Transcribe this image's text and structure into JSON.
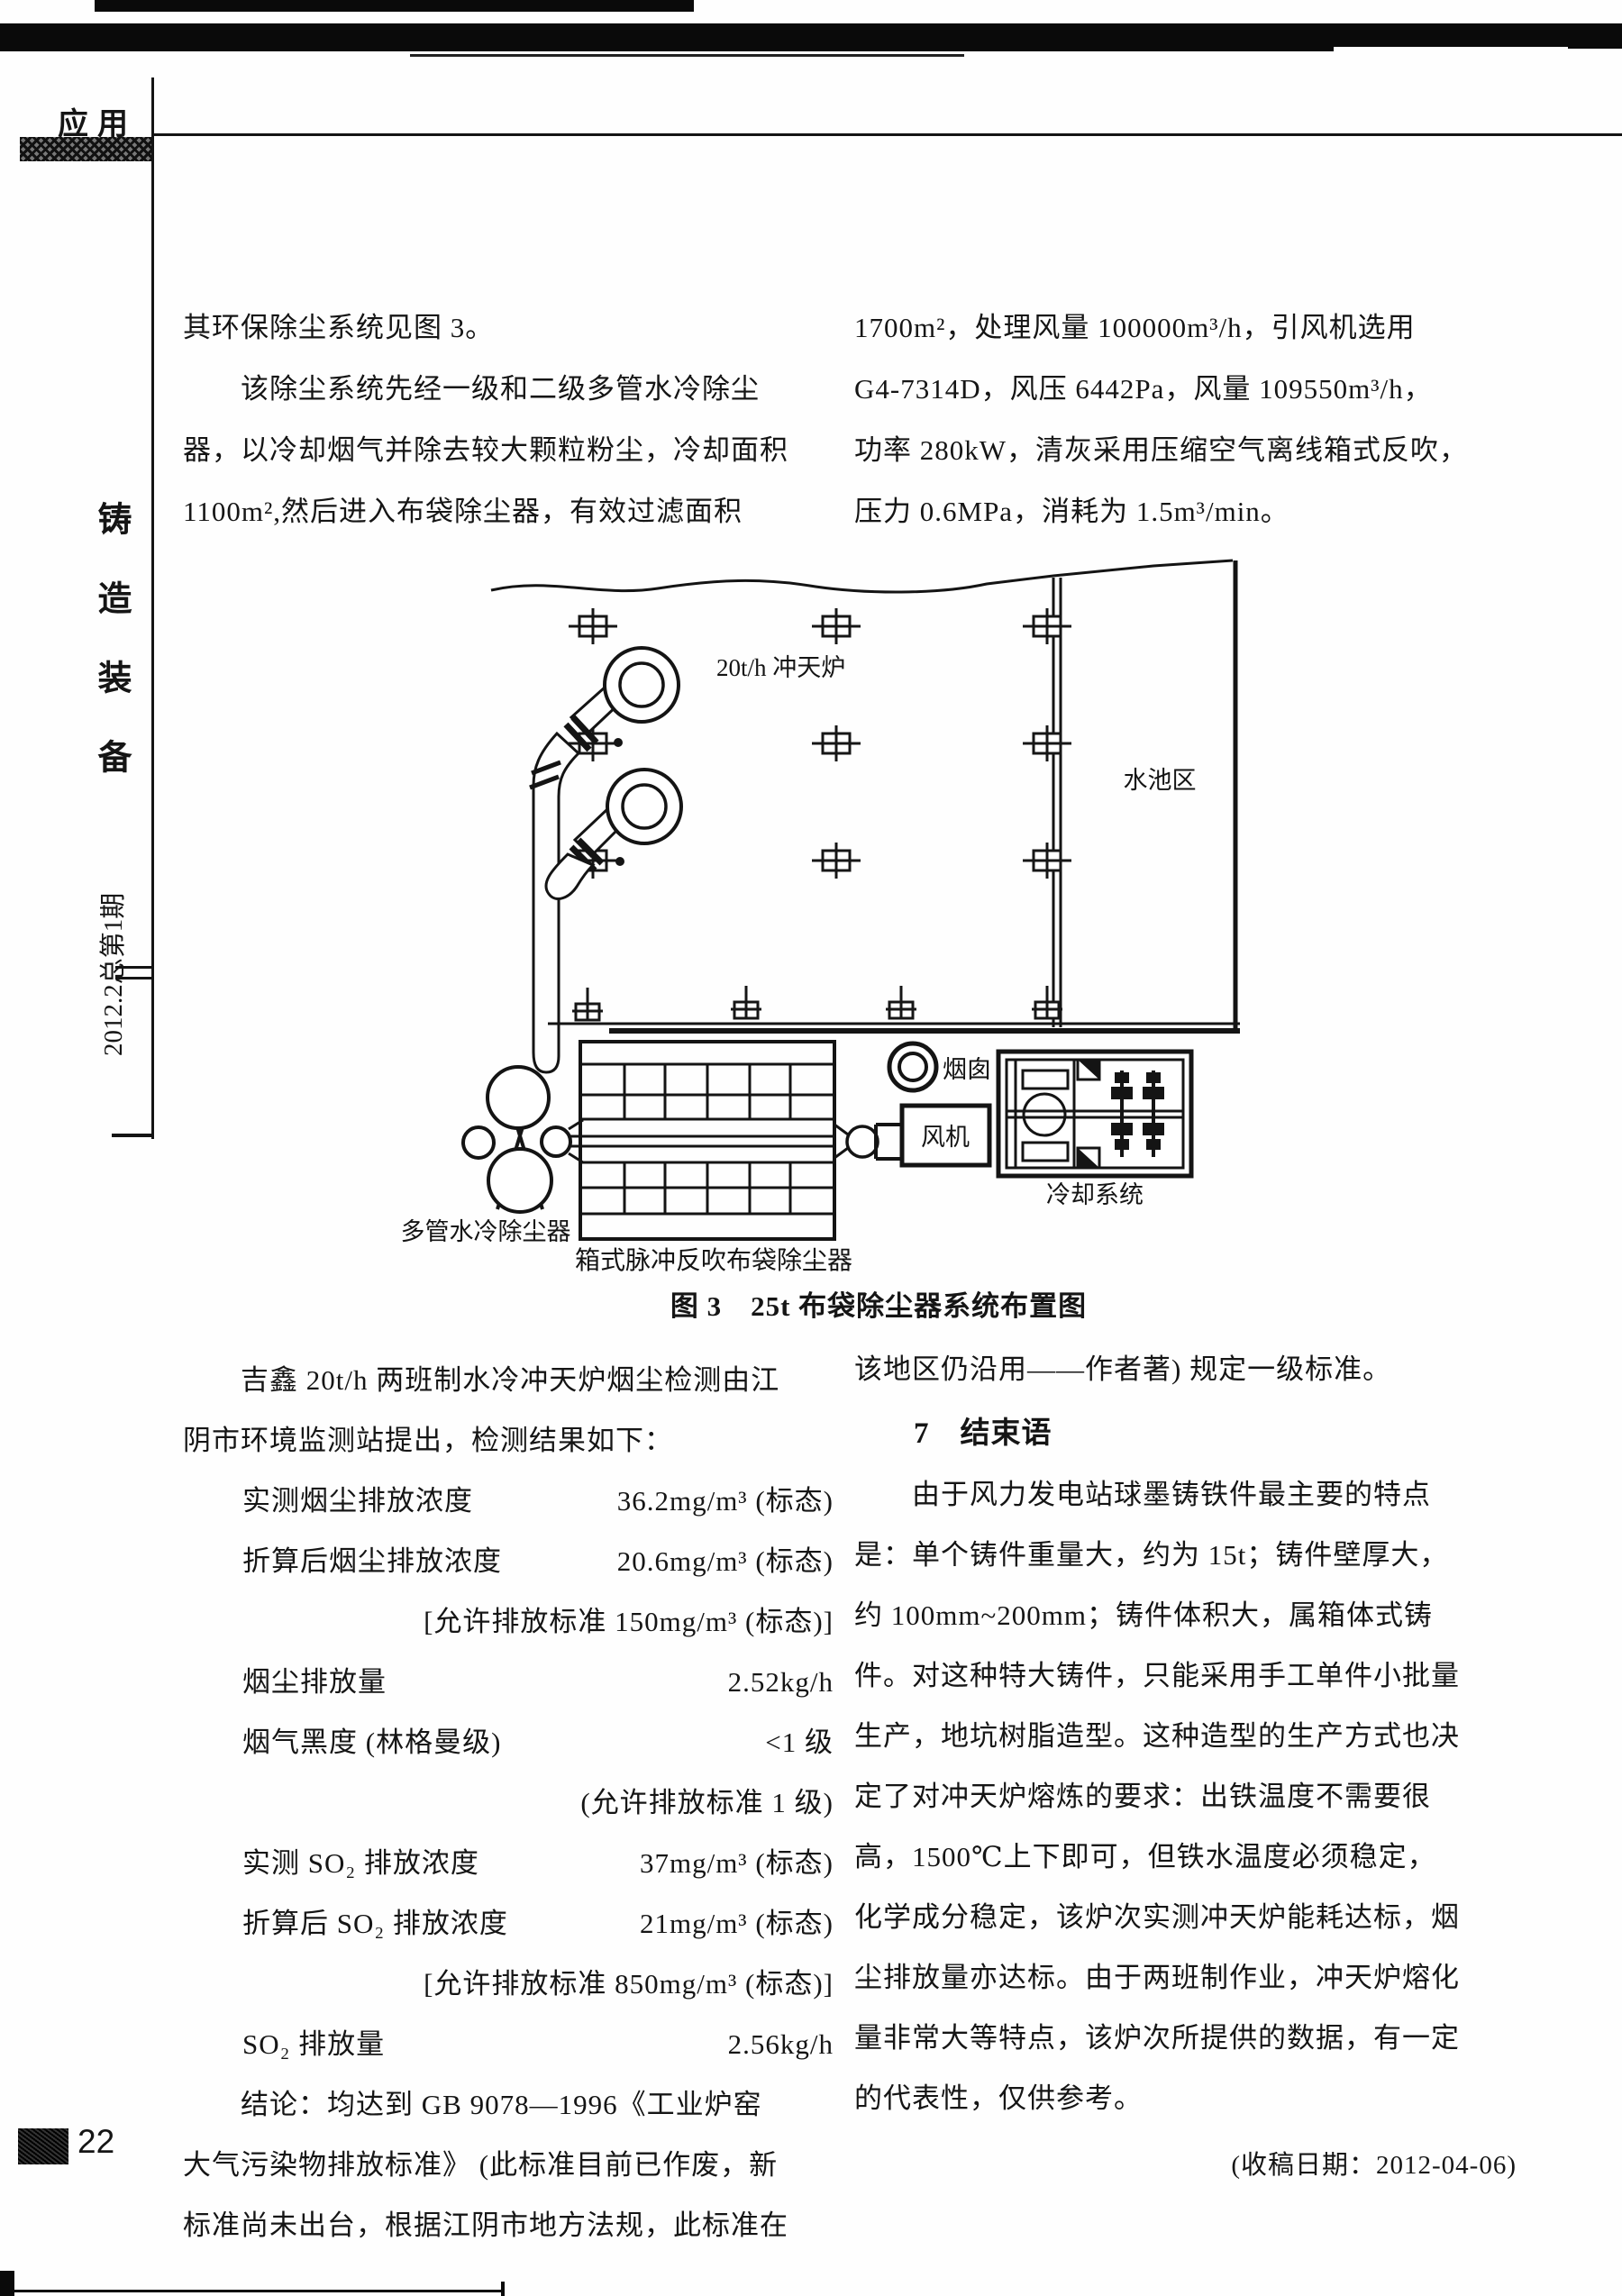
{
  "header": {
    "tab": "应用"
  },
  "sidebar": {
    "journal": "铸造装备",
    "issue": "2012.2总第1期",
    "page_number": "22"
  },
  "intro_left": {
    "lines": [
      "其环保除尘系统见图 3。",
      "　　该除尘系统先经一级和二级多管水冷除尘",
      "器，以冷却烟气并除去较大颗粒粉尘，冷却面积",
      "1100m²,然后进入布袋除尘器，有效过滤面积"
    ]
  },
  "intro_right": {
    "lines": [
      "1700m²，处理风量 100000m³/h，引风机选用",
      "G4-7314D，风压 6442Pa，风量 109550m³/h，",
      "功率 280kW，清灰采用压缩空气离线箱式反吹，",
      "压力 0.6MPa，消耗为 1.5m³/min。"
    ]
  },
  "figure": {
    "caption": "图 3　25t 布袋除尘器系统布置图",
    "labels": {
      "cupola": "20t/h 冲天炉",
      "pool": "水池区",
      "chimney": "烟囱",
      "fan": "风机",
      "cooling": "冷却系统",
      "multitube": "多管水冷除尘器",
      "baghouse": "箱式脉冲反吹布袋除尘器"
    }
  },
  "report": {
    "intro_lines": [
      "　　吉鑫 20t/h 两班制水冷冲天炉烟尘检测由江",
      "阴市环境监测站提出，检测结果如下："
    ],
    "measurements": [
      {
        "label": "实测烟尘排放浓度",
        "value": "36.2mg/m³ (标态)"
      },
      {
        "label": "折算后烟尘排放浓度",
        "value": "20.6mg/m³ (标态)"
      },
      {
        "label": "",
        "value": "[允许排放标准 150mg/m³ (标态)]"
      },
      {
        "label": "烟尘排放量",
        "value": "2.52kg/h"
      },
      {
        "label": "烟气黑度 (林格曼级)",
        "value": "<1 级"
      },
      {
        "label": "",
        "value": "(允许排放标准 1 级)"
      },
      {
        "label": "实测 SO₂ 排放浓度",
        "value": "37mg/m³ (标态)"
      },
      {
        "label": "折算后 SO₂ 排放浓度",
        "value": "21mg/m³ (标态)"
      },
      {
        "label": "",
        "value": "[允许排放标准 850mg/m³ (标态)]"
      },
      {
        "label": "SO₂ 排放量",
        "value": "2.56kg/h"
      }
    ],
    "conclusion_lines": [
      "　　结论：均达到 GB 9078—1996《工业炉窑",
      "大气污染物排放标准》 (此标准目前已作废，新",
      "标准尚未出台，根据江阴市地方法规，此标准在"
    ]
  },
  "closing": {
    "lead_line": "该地区仍沿用——作者著) 规定一级标准。",
    "heading": "7　结束语",
    "para_lines": [
      "　　由于风力发电站球墨铸铁件最主要的特点",
      "是：单个铸件重量大，约为 15t；铸件壁厚大，",
      "约 100mm~200mm；铸件体积大，属箱体式铸",
      "件。对这种特大铸件，只能采用手工单件小批量",
      "生产，地坑树脂造型。这种造型的生产方式也决",
      "定了对冲天炉熔炼的要求：出铁温度不需要很",
      "高，1500℃上下即可，但铁水温度必须稳定，",
      "化学成分稳定，该炉次实测冲天炉能耗达标，烟",
      "尘排放量亦达标。由于两班制作业，冲天炉熔化",
      "量非常大等特点，该炉次所提供的数据，有一定",
      "的代表性，仅供参考。"
    ],
    "received": "(收稿日期：2012-04-06)"
  }
}
